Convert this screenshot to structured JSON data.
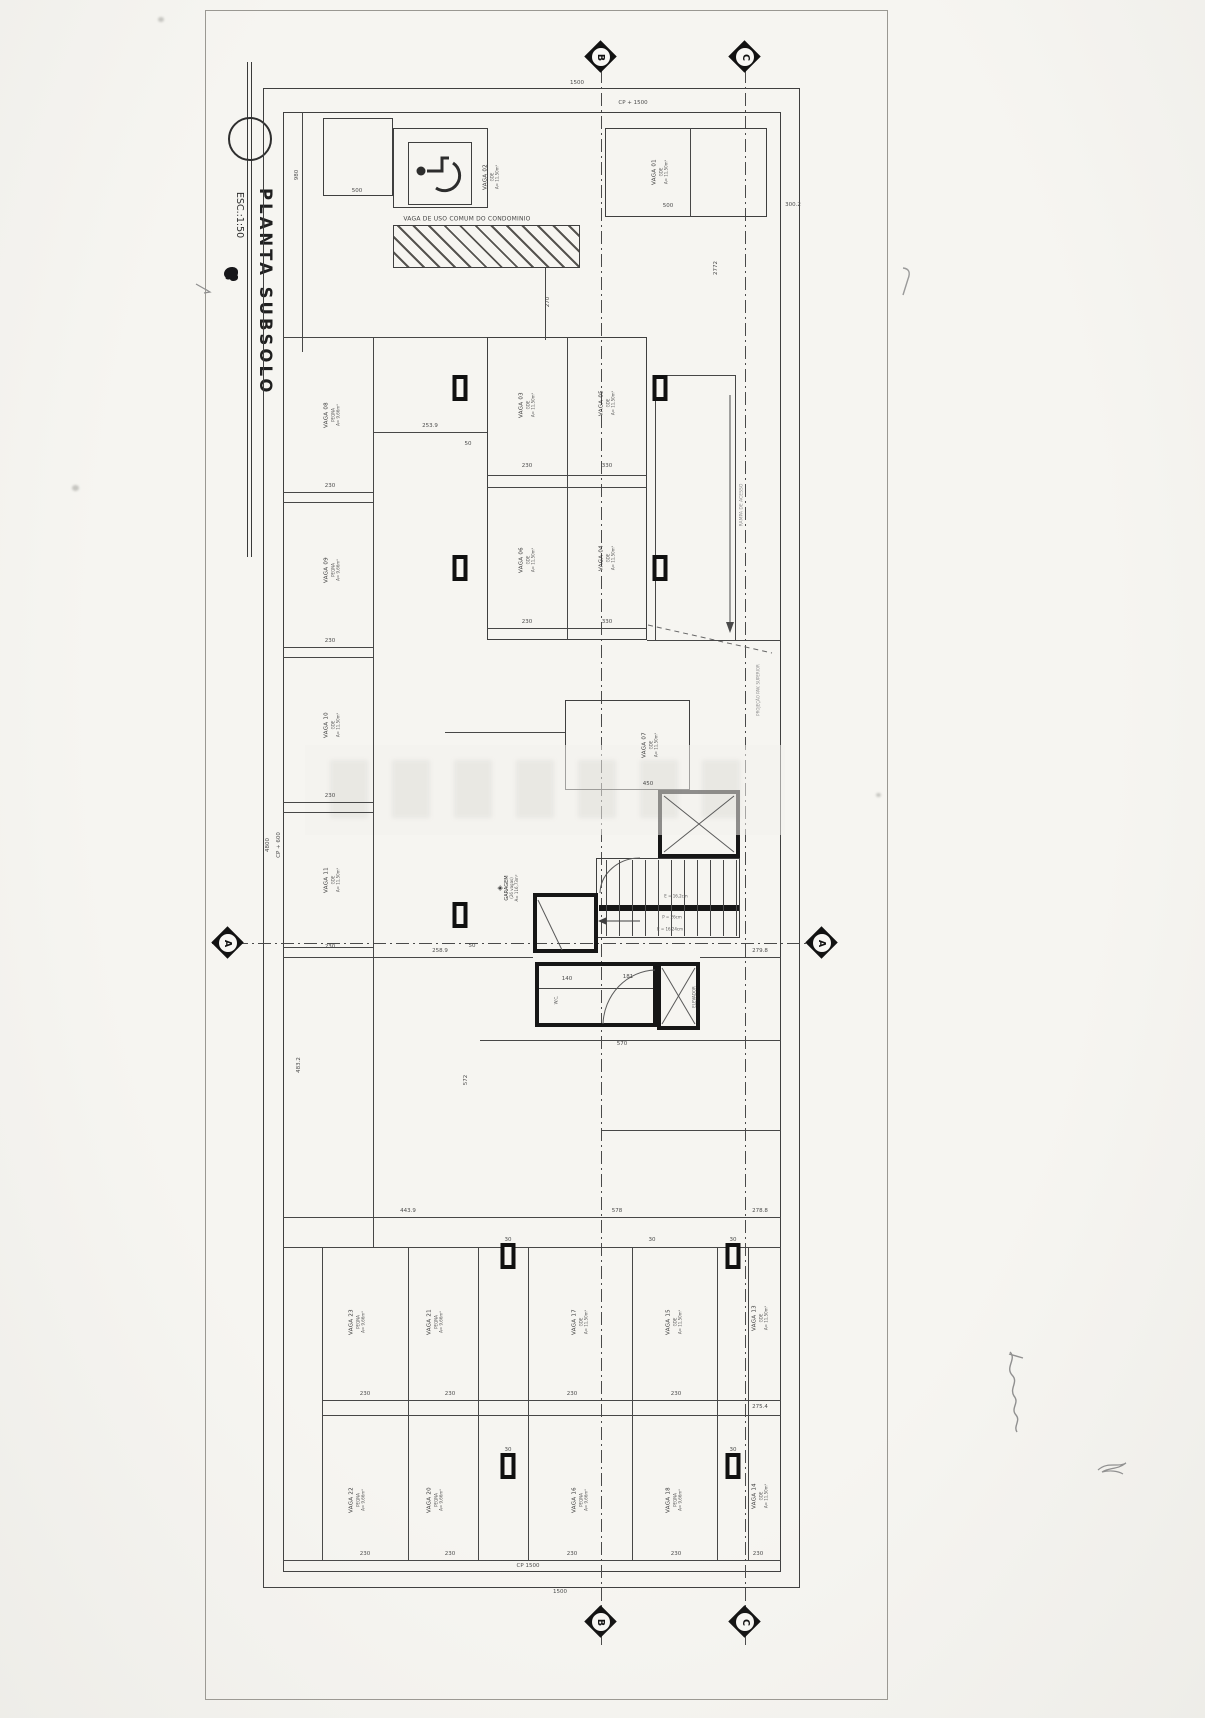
{
  "title_block": {
    "title": "PLANTA SUBSOLO",
    "scale": "ESC.:1:50"
  },
  "section_markers": {
    "top_b": "B",
    "top_c": "C",
    "left_a": "A",
    "right_a": "A",
    "bottom_b": "B",
    "bottom_c": "C"
  },
  "annotations": {
    "common_stall": "VAGA DE USO COMUM DO CONDOMINIO",
    "ramp_note": "RAMPA DE ACESSO",
    "projection_note": "PROJEÇÃO PAV. SUPERIOR"
  },
  "core": {
    "elevator": "ELEVADOR",
    "room": "W.C.",
    "garage": {
      "icon": "garagem-diamond-icon",
      "label": "GARAGEM",
      "sub": "(26 vagas)",
      "area": "A= 116,73m²"
    },
    "stair_notes": [
      {
        "t": "E = 16,2cm",
        "x": 676,
        "y": 896
      },
      {
        "t": "P = 26cm",
        "x": 672,
        "y": 917
      },
      {
        "t": "E = 16,24cm",
        "x": 670,
        "y": 929
      }
    ]
  },
  "stalls": [
    {
      "label": "VAGA 02",
      "sub": "GDE",
      "area": "A= 11,50m²",
      "x": 491,
      "y": 177
    },
    {
      "label": "VAGA 01",
      "sub": "GDE",
      "area": "A= 11,50m²",
      "x": 660,
      "y": 172
    },
    {
      "label": "VAGA 08",
      "sub": "PEQNA",
      "area": "A= 9,66m²",
      "x": 332,
      "y": 415
    },
    {
      "label": "VAGA 09",
      "sub": "PEQNA",
      "area": "A= 9,66m²",
      "x": 332,
      "y": 570
    },
    {
      "label": "VAGA 10",
      "sub": "GDE",
      "area": "A= 11,50m²",
      "x": 332,
      "y": 725
    },
    {
      "label": "VAGA 11",
      "sub": "GDE",
      "area": "A= 11,50m²",
      "x": 332,
      "y": 880
    },
    {
      "label": "VAGA 03",
      "sub": "GDE",
      "area": "A= 11,50m²",
      "x": 527,
      "y": 405
    },
    {
      "label": "VAGA 05",
      "sub": "GDE",
      "area": "A= 11,50m²",
      "x": 607,
      "y": 403
    },
    {
      "label": "VAGA 06",
      "sub": "GDE",
      "area": "A= 11,50m²",
      "x": 527,
      "y": 560
    },
    {
      "label": "VAGA 04",
      "sub": "GDE",
      "area": "A= 11,50m²",
      "x": 607,
      "y": 558
    },
    {
      "label": "VAGA 07",
      "sub": "GDE",
      "area": "A= 11,50m²",
      "x": 650,
      "y": 745
    },
    {
      "label": "VAGA 23",
      "sub": "PEQNA",
      "area": "A= 9,66m²",
      "x": 357,
      "y": 1322
    },
    {
      "label": "VAGA 21",
      "sub": "PEQNA",
      "area": "A= 9,66m²",
      "x": 435,
      "y": 1322
    },
    {
      "label": "VAGA 17",
      "sub": "GDE",
      "area": "A= 11,50m²",
      "x": 580,
      "y": 1322
    },
    {
      "label": "VAGA 15",
      "sub": "GDE",
      "area": "A= 11,50m²",
      "x": 674,
      "y": 1322
    },
    {
      "label": "VAGA 13",
      "sub": "GDE",
      "area": "A= 11,50m²",
      "x": 760,
      "y": 1318
    },
    {
      "label": "VAGA 22",
      "sub": "PEQNA",
      "area": "A= 9,66m²",
      "x": 357,
      "y": 1500
    },
    {
      "label": "VAGA 20",
      "sub": "PEQNA",
      "area": "A= 9,66m²",
      "x": 435,
      "y": 1500
    },
    {
      "label": "VAGA 16",
      "sub": "PEQNA",
      "area": "A= 9,66m²",
      "x": 580,
      "y": 1500
    },
    {
      "label": "VAGA 18",
      "sub": "PEQNA",
      "area": "A= 9,66m²",
      "x": 674,
      "y": 1500
    },
    {
      "label": "VAGA 14",
      "sub": "GDE",
      "area": "A= 11,50m²",
      "x": 760,
      "y": 1496
    }
  ],
  "dims": [
    {
      "t": "1500",
      "x": 577,
      "y": 83
    },
    {
      "t": "CP + 1500",
      "x": 633,
      "y": 103
    },
    {
      "t": "500",
      "x": 357,
      "y": 191
    },
    {
      "t": "500",
      "x": 668,
      "y": 206
    },
    {
      "t": "300.2",
      "x": 793,
      "y": 205
    },
    {
      "t": "2772",
      "x": 716,
      "y": 268,
      "r": 1
    },
    {
      "t": "270",
      "x": 548,
      "y": 302,
      "r": 1
    },
    {
      "t": "980",
      "x": 297,
      "y": 175,
      "r": 1
    },
    {
      "t": "253.9",
      "x": 430,
      "y": 426
    },
    {
      "t": "50",
      "x": 468,
      "y": 444
    },
    {
      "t": "230",
      "x": 527,
      "y": 466
    },
    {
      "t": "330",
      "x": 607,
      "y": 466
    },
    {
      "t": "230",
      "x": 527,
      "y": 622
    },
    {
      "t": "330",
      "x": 607,
      "y": 622
    },
    {
      "t": "230",
      "x": 330,
      "y": 486
    },
    {
      "t": "230",
      "x": 330,
      "y": 641
    },
    {
      "t": "230",
      "x": 330,
      "y": 796
    },
    {
      "t": "230",
      "x": 330,
      "y": 947
    },
    {
      "t": "450",
      "x": 648,
      "y": 784
    },
    {
      "t": "4800",
      "x": 268,
      "y": 845,
      "r": 1
    },
    {
      "t": "CP + 600",
      "x": 279,
      "y": 845,
      "r": 1
    },
    {
      "t": "258.9",
      "x": 440,
      "y": 951
    },
    {
      "t": "50",
      "x": 472,
      "y": 946
    },
    {
      "t": "279.8",
      "x": 760,
      "y": 951
    },
    {
      "t": "140",
      "x": 567,
      "y": 979
    },
    {
      "t": "181",
      "x": 628,
      "y": 977
    },
    {
      "t": "570",
      "x": 622,
      "y": 1044
    },
    {
      "t": "483.2",
      "x": 299,
      "y": 1065,
      "r": 1
    },
    {
      "t": "572",
      "x": 466,
      "y": 1080,
      "r": 1
    },
    {
      "t": "443.9",
      "x": 408,
      "y": 1211
    },
    {
      "t": "578",
      "x": 617,
      "y": 1211
    },
    {
      "t": "278.8",
      "x": 760,
      "y": 1211
    },
    {
      "t": "30",
      "x": 652,
      "y": 1240
    },
    {
      "t": "30",
      "x": 508,
      "y": 1240
    },
    {
      "t": "30",
      "x": 733,
      "y": 1240
    },
    {
      "t": "230",
      "x": 365,
      "y": 1394
    },
    {
      "t": "230",
      "x": 450,
      "y": 1394
    },
    {
      "t": "230",
      "x": 572,
      "y": 1394
    },
    {
      "t": "230",
      "x": 676,
      "y": 1394
    },
    {
      "t": "275.4",
      "x": 760,
      "y": 1407
    },
    {
      "t": "30",
      "x": 508,
      "y": 1450
    },
    {
      "t": "30",
      "x": 733,
      "y": 1450
    },
    {
      "t": "230",
      "x": 365,
      "y": 1554
    },
    {
      "t": "230",
      "x": 450,
      "y": 1554
    },
    {
      "t": "230",
      "x": 572,
      "y": 1554
    },
    {
      "t": "230",
      "x": 676,
      "y": 1554
    },
    {
      "t": "230",
      "x": 758,
      "y": 1554
    },
    {
      "t": "CP 1500",
      "x": 528,
      "y": 1566
    },
    {
      "t": "1500",
      "x": 560,
      "y": 1592
    }
  ],
  "columns": [
    {
      "x": 460,
      "y": 388
    },
    {
      "x": 660,
      "y": 388
    },
    {
      "x": 460,
      "y": 568
    },
    {
      "x": 660,
      "y": 568
    },
    {
      "x": 460,
      "y": 915
    },
    {
      "x": 508,
      "y": 1256
    },
    {
      "x": 733,
      "y": 1256
    },
    {
      "x": 508,
      "y": 1466
    },
    {
      "x": 733,
      "y": 1466
    }
  ]
}
